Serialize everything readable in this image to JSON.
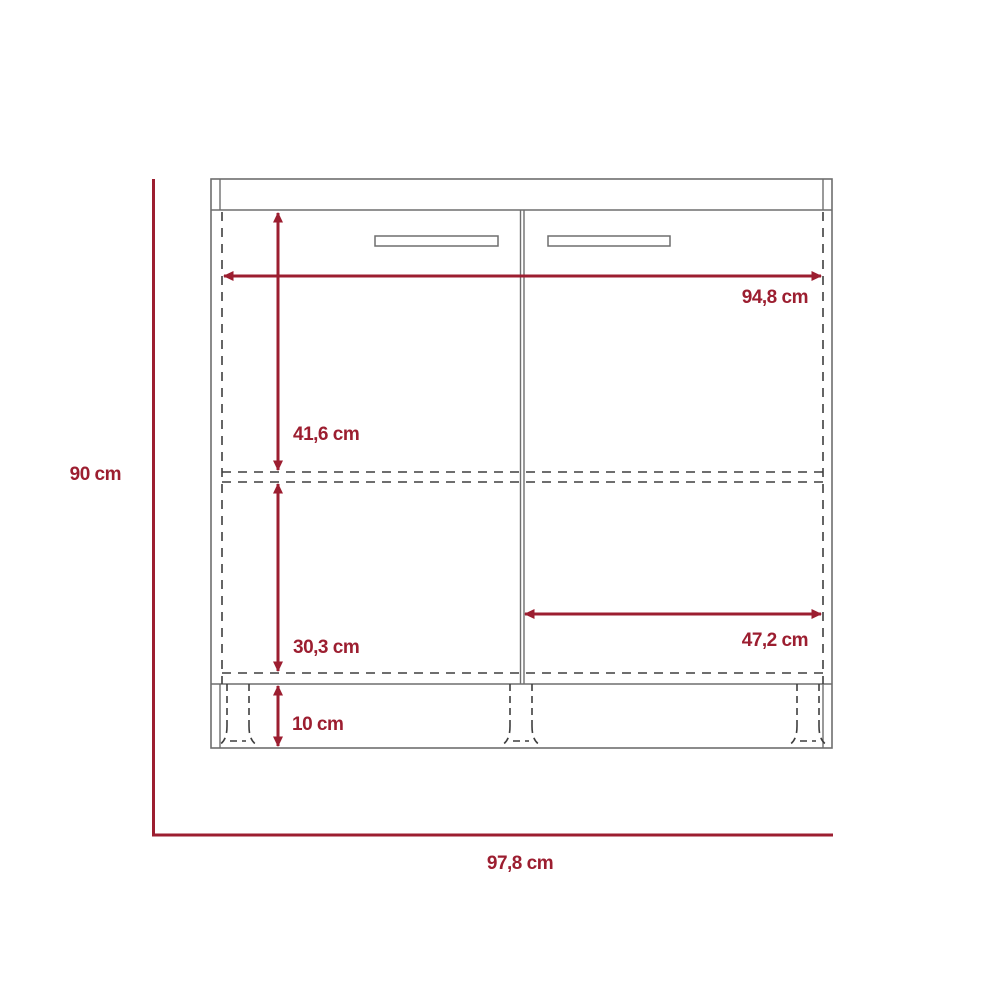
{
  "diagram": {
    "kind": "cabinet-front-dimension-drawing",
    "unit": "cm",
    "labels": {
      "overall_height": "90 cm",
      "overall_width": "97,8 cm",
      "interior_width": "94,8 cm",
      "upper_section_height": "41,6 cm",
      "lower_section_height": "30,3 cm",
      "plinth_height": "10 cm",
      "door_width": "47,2 cm"
    },
    "colors": {
      "dimension_red": "#9c1e30",
      "cabinet_line_gray": "#6e6e6e",
      "hidden_line_gray": "#3f3f3f",
      "background": "#ffffff"
    }
  }
}
